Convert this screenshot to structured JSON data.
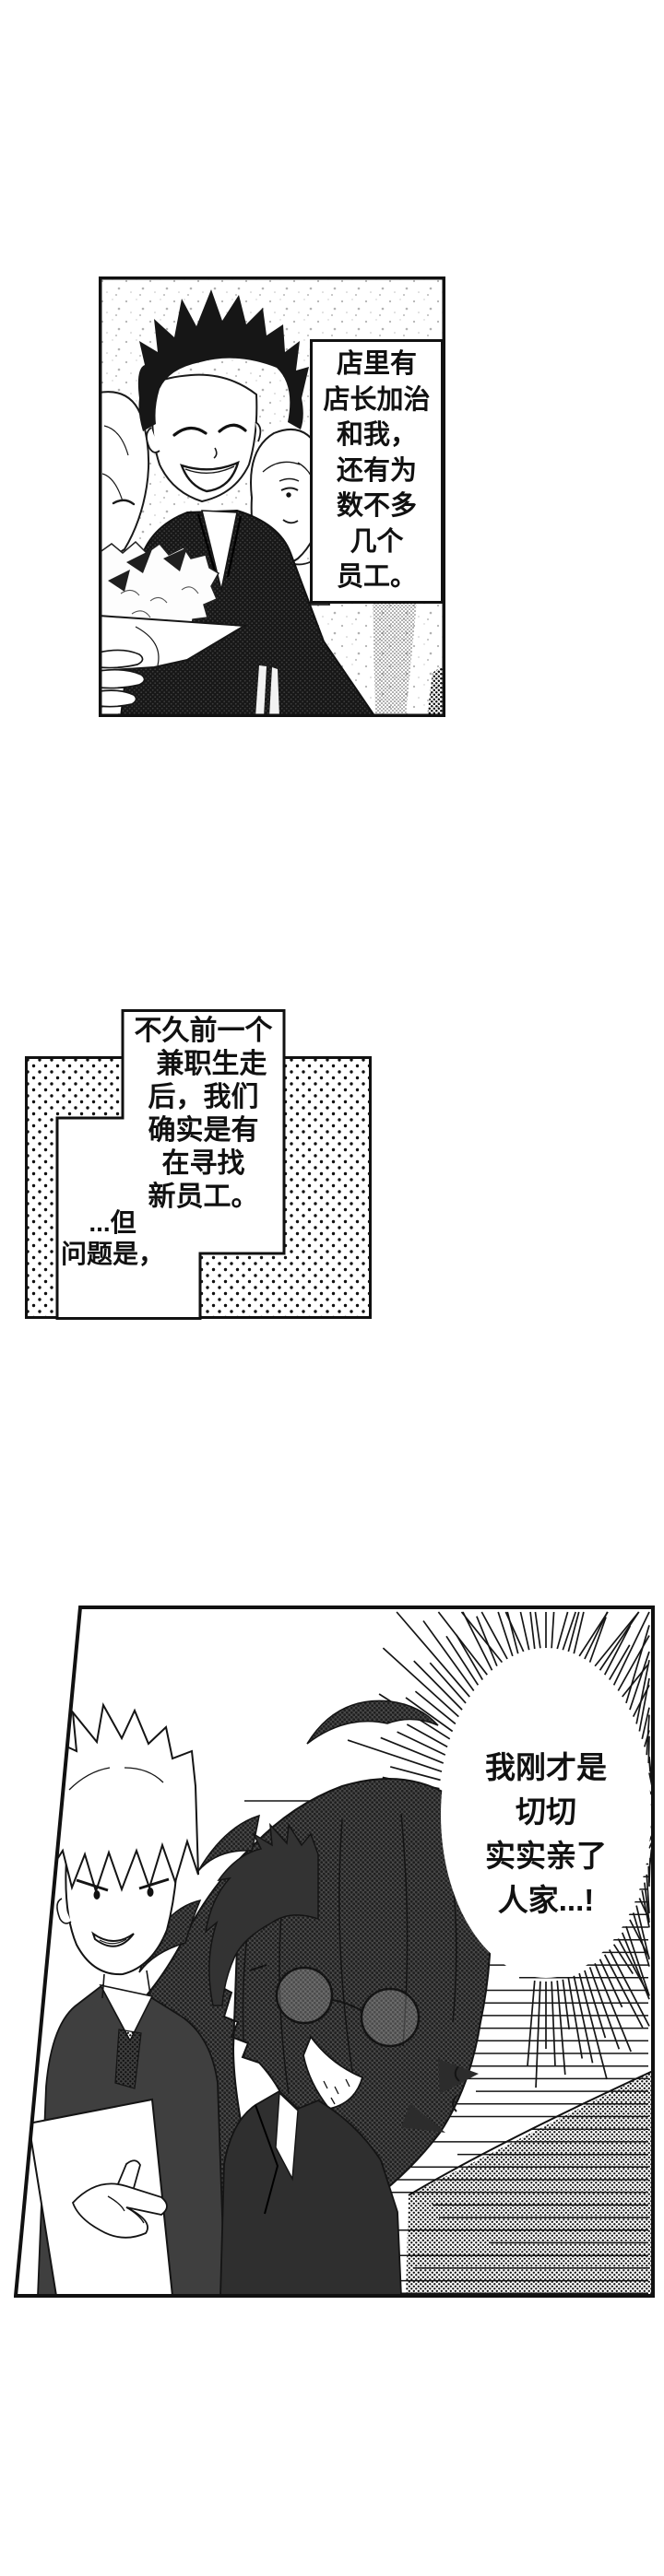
{
  "page": {
    "background": "#ffffff",
    "ink": "#111111",
    "halftone": "#9b9b9b"
  },
  "panel1": {
    "narration": {
      "lines": [
        "店里有",
        "店长加治",
        "和我，",
        "还有为",
        "数不多",
        "几个",
        "员工。"
      ]
    }
  },
  "panel2": {
    "narration": {
      "lines": [
        "不久前一个",
        "兼职生走",
        "后，我们",
        "确实是有",
        "在寻找",
        "新员工。"
      ]
    },
    "aside": {
      "lines": [
        "...但",
        "问题是，"
      ]
    }
  },
  "panel3": {
    "speech_bubble": {
      "lines": [
        "我刚才是",
        "切切",
        "实实亲了",
        "人家...!"
      ]
    }
  }
}
